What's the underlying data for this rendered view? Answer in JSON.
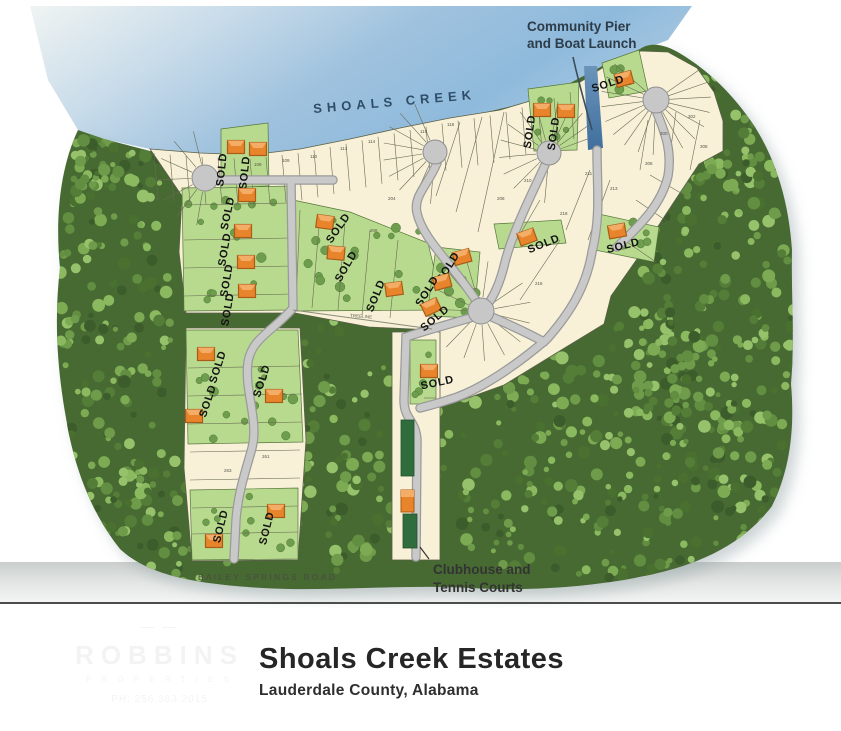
{
  "map": {
    "water_label": "SHOALS CREEK",
    "sold_label": "SOLD",
    "annotations": {
      "pier_line1": "Community Pier",
      "pier_line2": "and Boat Launch",
      "clubhouse_line1": "Clubhouse and",
      "clubhouse_line2": "Tennis Courts",
      "road_label": "BAILEY SPRINGS ROAD",
      "treeline_label": "TREELINE"
    },
    "colors": {
      "water": "#9ec4e0",
      "water_pale": "#eef3f1",
      "channel": "#4a7ca8",
      "forest_base": "#466a31",
      "lot_cream": "#f8f1d8",
      "lot_green": "#b8da8e",
      "road_gray": "#c7c7c7",
      "house_orange": "#e8852c",
      "court_green": "#2f6e3c",
      "label_dark": "#2d3c48"
    },
    "sold_lots": [
      {
        "x": 236,
        "y": 147,
        "hr": 0,
        "lx": 225,
        "ly": 170,
        "rot": -84
      },
      {
        "x": 258,
        "y": 149,
        "hr": 0,
        "lx": 248,
        "ly": 173,
        "rot": -84
      },
      {
        "x": 247,
        "y": 195,
        "hr": 0,
        "lx": 231,
        "ly": 214,
        "rot": -78
      },
      {
        "x": 243,
        "y": 231,
        "hr": 0,
        "lx": 228,
        "ly": 250,
        "rot": -80
      },
      {
        "x": 246,
        "y": 262,
        "hr": 0,
        "lx": 230,
        "ly": 281,
        "rot": -80
      },
      {
        "x": 247,
        "y": 291,
        "hr": 0,
        "lx": 231,
        "ly": 310,
        "rot": -80
      },
      {
        "x": 325,
        "y": 222,
        "hr": 8,
        "lx": 341,
        "ly": 230,
        "rot": -55
      },
      {
        "x": 336,
        "y": 253,
        "hr": 5,
        "lx": 349,
        "ly": 268,
        "rot": -60
      },
      {
        "x": 394,
        "y": 289,
        "hr": -8,
        "lx": 379,
        "ly": 297,
        "rot": -68
      },
      {
        "x": 527,
        "y": 237,
        "hr": -20,
        "lx": 545,
        "ly": 247,
        "rot": -22
      },
      {
        "x": 462,
        "y": 257,
        "hr": -15,
        "lx": 451,
        "ly": 269,
        "rot": -58
      },
      {
        "x": 442,
        "y": 282,
        "hr": -15,
        "lx": 430,
        "ly": 293,
        "rot": -58
      },
      {
        "x": 431,
        "y": 307,
        "hr": -25,
        "lx": 437,
        "ly": 321,
        "rot": -40
      },
      {
        "x": 617,
        "y": 231,
        "hr": -10,
        "lx": 624,
        "ly": 249,
        "rot": -14
      },
      {
        "x": 542,
        "y": 110,
        "hr": 0,
        "lx": 533,
        "ly": 132,
        "rot": -82
      },
      {
        "x": 566,
        "y": 111,
        "hr": 0,
        "lx": 557,
        "ly": 134,
        "rot": -82
      },
      {
        "x": 624,
        "y": 79,
        "hr": -15,
        "lx": 609,
        "ly": 87,
        "rot": -18
      },
      {
        "x": 429,
        "y": 371,
        "hr": 0,
        "lx": 438,
        "ly": 386,
        "rot": -12
      },
      {
        "x": 206,
        "y": 354,
        "hr": 0,
        "lx": 221,
        "ly": 368,
        "rot": -72
      },
      {
        "x": 194,
        "y": 416,
        "hr": 0,
        "lx": 211,
        "ly": 402,
        "rot": -72
      },
      {
        "x": 274,
        "y": 396,
        "hr": 0,
        "lx": 265,
        "ly": 382,
        "rot": -72
      },
      {
        "x": 214,
        "y": 541,
        "hr": 0,
        "lx": 224,
        "ly": 527,
        "rot": -76
      },
      {
        "x": 276,
        "y": 511,
        "hr": 0,
        "lx": 270,
        "ly": 529,
        "rot": -76
      }
    ],
    "lot_numbers": [
      {
        "x": 254,
        "y": 166,
        "n": "108"
      },
      {
        "x": 282,
        "y": 162,
        "n": "109"
      },
      {
        "x": 310,
        "y": 158,
        "n": "110"
      },
      {
        "x": 340,
        "y": 150,
        "n": "113"
      },
      {
        "x": 368,
        "y": 143,
        "n": "114"
      },
      {
        "x": 420,
        "y": 133,
        "n": "119"
      },
      {
        "x": 447,
        "y": 126,
        "n": "118"
      },
      {
        "x": 388,
        "y": 200,
        "n": "204"
      },
      {
        "x": 370,
        "y": 232,
        "n": "206"
      },
      {
        "x": 497,
        "y": 200,
        "n": "208"
      },
      {
        "x": 524,
        "y": 182,
        "n": "210"
      },
      {
        "x": 585,
        "y": 175,
        "n": "211"
      },
      {
        "x": 610,
        "y": 190,
        "n": "213"
      },
      {
        "x": 560,
        "y": 215,
        "n": "218"
      },
      {
        "x": 535,
        "y": 285,
        "n": "216"
      },
      {
        "x": 660,
        "y": 135,
        "n": "300"
      },
      {
        "x": 688,
        "y": 118,
        "n": "302"
      },
      {
        "x": 645,
        "y": 165,
        "n": "306"
      },
      {
        "x": 700,
        "y": 148,
        "n": "308"
      },
      {
        "x": 262,
        "y": 458,
        "n": "261"
      },
      {
        "x": 224,
        "y": 472,
        "n": "263"
      }
    ]
  },
  "footer": {
    "title": "Shoals Creek Estates",
    "subtitle": "Lauderdale County, Alabama",
    "watermark_mark": "— —",
    "watermark_name": "ROBBINS",
    "watermark_sub": "P R O P E R T I E S",
    "watermark_phone": "PH: 256.383.2015"
  }
}
